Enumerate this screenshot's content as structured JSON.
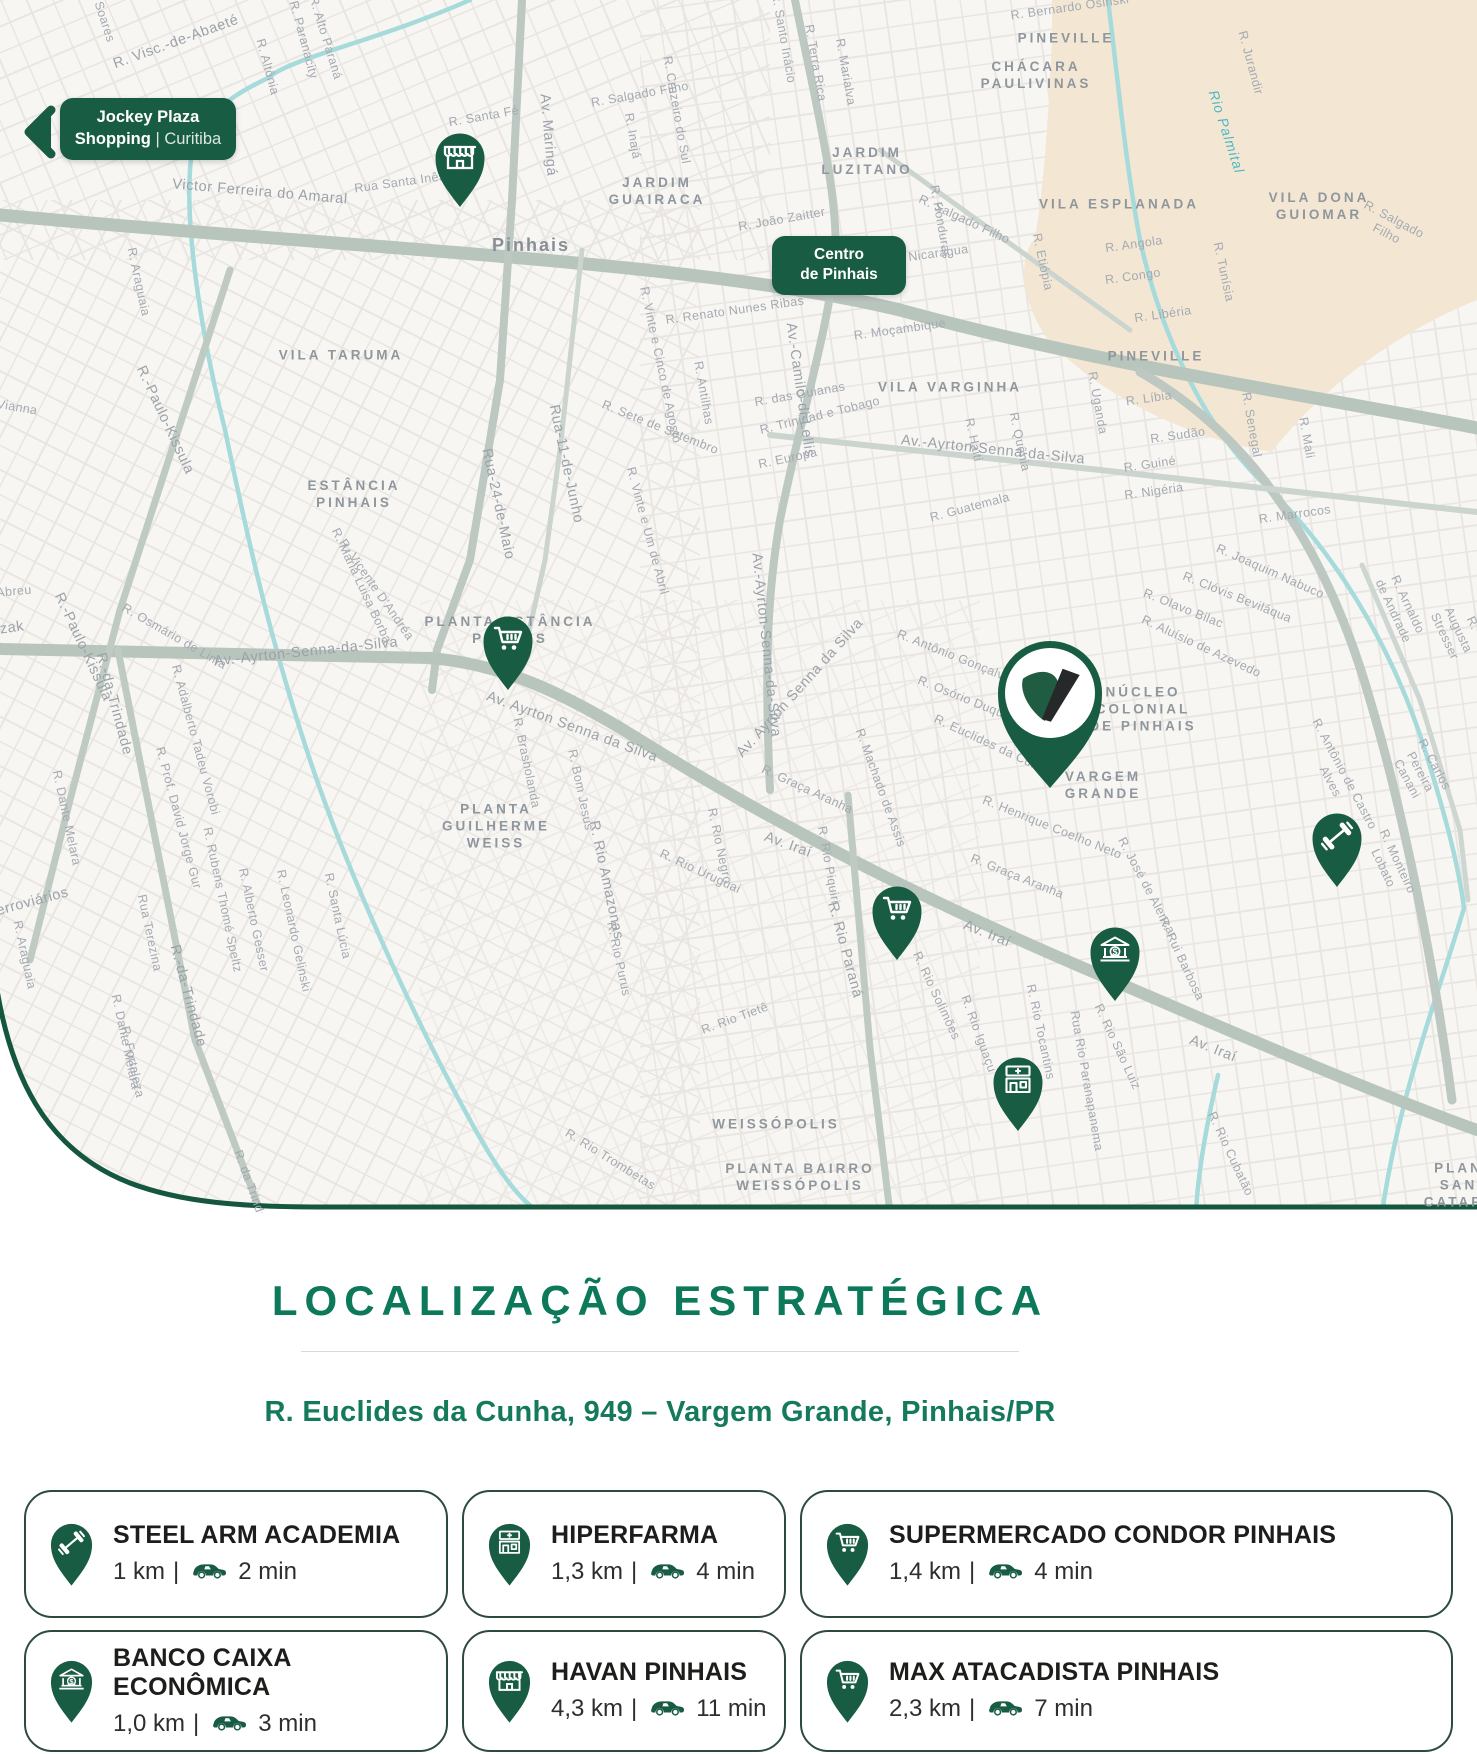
{
  "brand": {
    "green": "#195C44",
    "title_green": "#0C795A",
    "address_green": "#157A5C",
    "map_bg": "#F8F6F3",
    "tan": "#F3E7D4",
    "river": "#A6DADB",
    "road": "#B8C5BD",
    "logo_leaf": "#1F5C41",
    "logo_slash": "#26292A"
  },
  "map": {
    "badges": {
      "jockey": {
        "line1": "Jockey Plaza",
        "line2_bold": "Shopping",
        "line2_sep": "|",
        "line2_rest": "Curitiba"
      },
      "centro": {
        "line1": "Centro",
        "line2": "de Pinhais"
      }
    },
    "pins": [
      {
        "name": "store-pin",
        "icon": "store",
        "x": 460,
        "y": 208,
        "w": 56
      },
      {
        "name": "supermarket-pin-1",
        "icon": "cart",
        "x": 508,
        "y": 691,
        "w": 56
      },
      {
        "name": "property-pin",
        "icon": "vlogo",
        "x": 1050,
        "y": 792,
        "w": 122
      },
      {
        "name": "gym-pin",
        "icon": "dumbbell",
        "x": 1337,
        "y": 888,
        "w": 56
      },
      {
        "name": "supermarket-pin-2",
        "icon": "cart",
        "x": 897,
        "y": 961,
        "w": 56
      },
      {
        "name": "bank-pin",
        "icon": "bank",
        "x": 1115,
        "y": 1002,
        "w": 56
      },
      {
        "name": "pharmacy-pin",
        "icon": "pharmacy",
        "x": 1018,
        "y": 1132,
        "w": 56
      }
    ],
    "labels": [
      {
        "t": "VILA TARUMA",
        "x": 341,
        "y": 356,
        "r": 0,
        "k": "hood"
      },
      {
        "t": "ESTÂNCIA\nPINHAIS",
        "x": 354,
        "y": 495,
        "r": 0,
        "k": "hood"
      },
      {
        "t": "PLANTA ESTÂNCIA\nPINHAIS",
        "x": 510,
        "y": 631,
        "r": 0,
        "k": "hood"
      },
      {
        "t": "PLANTA\nGUILHERME\nWEISS",
        "x": 496,
        "y": 827,
        "r": 0,
        "k": "hood"
      },
      {
        "t": "JARDIM\nGUAIRACA",
        "x": 657,
        "y": 192,
        "r": 0,
        "k": "hood"
      },
      {
        "t": "JARDIM\nLUZITANO",
        "x": 867,
        "y": 162,
        "r": 0,
        "k": "hood"
      },
      {
        "t": "CHÁCARA\nPAULIVINAS",
        "x": 1036,
        "y": 76,
        "r": 0,
        "k": "hood"
      },
      {
        "t": "PINEVILLE",
        "x": 1066,
        "y": 39,
        "r": 0,
        "k": "hood"
      },
      {
        "t": "PINEVILLE",
        "x": 1156,
        "y": 357,
        "r": 0,
        "k": "hood"
      },
      {
        "t": "VILA ESPLANADA",
        "x": 1119,
        "y": 205,
        "r": 0,
        "k": "hood"
      },
      {
        "t": "VILA DONA\nGUIOMAR",
        "x": 1319,
        "y": 207,
        "r": 0,
        "k": "hood"
      },
      {
        "t": "VILA VARGINHA",
        "x": 950,
        "y": 388,
        "r": 0,
        "k": "hood"
      },
      {
        "t": "NÚCLEO\nCOLONIAL\nDE PINHAIS",
        "x": 1143,
        "y": 710,
        "r": 0,
        "k": "hood"
      },
      {
        "t": "VARGEM\nGRANDE",
        "x": 1103,
        "y": 786,
        "r": 0,
        "k": "hood"
      },
      {
        "t": "WEISSÓPOLIS",
        "x": 776,
        "y": 1125,
        "r": 0,
        "k": "hood"
      },
      {
        "t": "PLANTA BAIRRO\nWEISSÓPOLIS",
        "x": 800,
        "y": 1178,
        "r": 0,
        "k": "hood"
      },
      {
        "t": "PLANTA SANTA\nCATARINA",
        "x": 1470,
        "y": 1186,
        "r": 0,
        "k": "hood"
      },
      {
        "t": "Pinhais",
        "x": 531,
        "y": 245,
        "r": 0,
        "k": "city"
      },
      {
        "t": "Rio Palmital",
        "x": 1226,
        "y": 132,
        "r": 72,
        "k": "river"
      },
      {
        "t": "Victor Ferreira do Amaral",
        "x": 260,
        "y": 192,
        "r": 5,
        "k": "st2"
      },
      {
        "t": "R. Visc.-de-Abaeté",
        "x": 176,
        "y": 42,
        "r": -20,
        "k": "st2"
      },
      {
        "t": "Soares",
        "x": 104,
        "y": 22,
        "r": 72,
        "k": "st"
      },
      {
        "t": "R. Altônia",
        "x": 267,
        "y": 67,
        "r": 75,
        "k": "st"
      },
      {
        "t": "R. Paranacity",
        "x": 303,
        "y": 40,
        "r": 75,
        "k": "st"
      },
      {
        "t": "R. Alto Paraná",
        "x": 325,
        "y": 38,
        "r": 73,
        "k": "st"
      },
      {
        "t": "R. Santa Fé",
        "x": 484,
        "y": 117,
        "r": -10,
        "k": "st"
      },
      {
        "t": "Rua Santa Inês",
        "x": 400,
        "y": 183,
        "r": -8,
        "k": "st"
      },
      {
        "t": "Av. Maringá",
        "x": 548,
        "y": 135,
        "r": 85,
        "k": "st2"
      },
      {
        "t": "R. Salgado Filho",
        "x": 640,
        "y": 95,
        "r": -10,
        "k": "st"
      },
      {
        "t": "R. Inajá",
        "x": 632,
        "y": 136,
        "r": 80,
        "k": "st"
      },
      {
        "t": "R. Cruzeiro do Sul",
        "x": 676,
        "y": 110,
        "r": 80,
        "k": "st"
      },
      {
        "t": "R. Santo Inácio",
        "x": 783,
        "y": 38,
        "r": 80,
        "k": "st"
      },
      {
        "t": "R. Terra Rica",
        "x": 815,
        "y": 63,
        "r": 80,
        "k": "st"
      },
      {
        "t": "R. Marialva",
        "x": 845,
        "y": 72,
        "r": 80,
        "k": "st"
      },
      {
        "t": "R. Bernardo Osinski",
        "x": 1070,
        "y": 8,
        "r": -8,
        "k": "st"
      },
      {
        "t": "R. Jurandir",
        "x": 1250,
        "y": 63,
        "r": 75,
        "k": "st"
      },
      {
        "t": "R. Salgado Filho",
        "x": 964,
        "y": 220,
        "r": 25,
        "k": "st"
      },
      {
        "t": "R. Salgado Filho",
        "x": 1390,
        "y": 227,
        "r": 28,
        "k": "st"
      },
      {
        "t": "R. João Zaitter",
        "x": 782,
        "y": 220,
        "r": -10,
        "k": "st"
      },
      {
        "t": "R. Nicarágua",
        "x": 930,
        "y": 255,
        "r": -8,
        "k": "st"
      },
      {
        "t": "R. Honduras",
        "x": 940,
        "y": 222,
        "r": 80,
        "k": "st"
      },
      {
        "t": "R. Etiópia",
        "x": 1042,
        "y": 262,
        "r": 78,
        "k": "st"
      },
      {
        "t": "R. Angola",
        "x": 1134,
        "y": 245,
        "r": -8,
        "k": "st"
      },
      {
        "t": "R. Congo",
        "x": 1133,
        "y": 277,
        "r": -8,
        "k": "st"
      },
      {
        "t": "R. Libéria",
        "x": 1163,
        "y": 315,
        "r": -8,
        "k": "st"
      },
      {
        "t": "R. Tunísia",
        "x": 1223,
        "y": 272,
        "r": 78,
        "k": "st"
      },
      {
        "t": "R. Uganda",
        "x": 1097,
        "y": 403,
        "r": 80,
        "k": "st"
      },
      {
        "t": "R. Líbia",
        "x": 1149,
        "y": 399,
        "r": -8,
        "k": "st"
      },
      {
        "t": "R. Sudão",
        "x": 1178,
        "y": 436,
        "r": -8,
        "k": "st"
      },
      {
        "t": "R. Guiné",
        "x": 1150,
        "y": 465,
        "r": -8,
        "k": "st"
      },
      {
        "t": "R. Nigéria",
        "x": 1154,
        "y": 492,
        "r": -8,
        "k": "st"
      },
      {
        "t": "R. Senegal",
        "x": 1251,
        "y": 425,
        "r": 80,
        "k": "st"
      },
      {
        "t": "R. Mali",
        "x": 1306,
        "y": 438,
        "r": 80,
        "k": "st"
      },
      {
        "t": "R. Marrocos",
        "x": 1295,
        "y": 515,
        "r": -8,
        "k": "st"
      },
      {
        "t": "R. Moçambique",
        "x": 900,
        "y": 330,
        "r": -8,
        "k": "st"
      },
      {
        "t": "R. Renato Nunes Ribas",
        "x": 735,
        "y": 311,
        "r": -8,
        "k": "st"
      },
      {
        "t": "R. das Guianas",
        "x": 800,
        "y": 395,
        "r": -10,
        "k": "st"
      },
      {
        "t": "R. Haiti",
        "x": 973,
        "y": 440,
        "r": 78,
        "k": "st"
      },
      {
        "t": "R. Quênia",
        "x": 1019,
        "y": 442,
        "r": 78,
        "k": "st"
      },
      {
        "t": "R. Guatemala",
        "x": 970,
        "y": 508,
        "r": -15,
        "k": "st"
      },
      {
        "t": "Av.-Camilo-di-Lellis",
        "x": 800,
        "y": 390,
        "r": 82,
        "k": "st2"
      },
      {
        "t": "R.-Paulo-Kissula",
        "x": 165,
        "y": 420,
        "r": 65,
        "k": "st2"
      },
      {
        "t": "R.-Paulo-Kissula",
        "x": 83,
        "y": 647,
        "r": 65,
        "k": "st2"
      },
      {
        "t": "R. Araguaia",
        "x": 138,
        "y": 282,
        "r": 78,
        "k": "st"
      },
      {
        "t": "Vianna",
        "x": 17,
        "y": 408,
        "r": 10,
        "k": "st"
      },
      {
        "t": "R. Osmário de Lima",
        "x": 174,
        "y": 637,
        "r": 30,
        "k": "st"
      },
      {
        "t": "Rua-24-de-Maio",
        "x": 498,
        "y": 504,
        "r": 78,
        "k": "st2"
      },
      {
        "t": "Rua-11-de-Junho",
        "x": 566,
        "y": 464,
        "r": 78,
        "k": "st2"
      },
      {
        "t": "R. Sete de Setembro",
        "x": 660,
        "y": 428,
        "r": 22,
        "k": "st"
      },
      {
        "t": "R. Vinte e Um de Abril",
        "x": 647,
        "y": 531,
        "r": 75,
        "k": "st"
      },
      {
        "t": "R. Vicente D'Andréa",
        "x": 376,
        "y": 590,
        "r": 55,
        "k": "st"
      },
      {
        "t": "R. Maria Luisa Borba",
        "x": 361,
        "y": 586,
        "r": 65,
        "k": "st"
      },
      {
        "t": "R. Europa",
        "x": 788,
        "y": 459,
        "r": -12,
        "k": "st"
      },
      {
        "t": "R. Trinidad e Tobago",
        "x": 820,
        "y": 416,
        "r": -14,
        "k": "st"
      },
      {
        "t": "R. Antilhas",
        "x": 703,
        "y": 393,
        "r": 80,
        "k": "st"
      },
      {
        "t": "R. Vinte e Cinco de Agosto",
        "x": 660,
        "y": 365,
        "r": 78,
        "k": "st"
      },
      {
        "t": "Av.-Ayrton-Senna-da-Silva",
        "x": 306,
        "y": 652,
        "r": -6,
        "k": "st2"
      },
      {
        "t": "Av. Ayrton Senna da Silva",
        "x": 572,
        "y": 727,
        "r": 20,
        "k": "st2"
      },
      {
        "t": "Av.-Ayrton-Senna-da-Silva",
        "x": 993,
        "y": 450,
        "r": 6,
        "k": "st2"
      },
      {
        "t": "Av.-Ayrton-Senna-da-Silva",
        "x": 766,
        "y": 645,
        "r": 84,
        "k": "st2"
      },
      {
        "t": "Av. Ayrton Senna da Silva",
        "x": 800,
        "y": 688,
        "r": -48,
        "k": "st2"
      },
      {
        "t": "Abreu",
        "x": 14,
        "y": 592,
        "r": -5,
        "k": "st"
      },
      {
        "t": "zak",
        "x": 12,
        "y": 628,
        "r": -8,
        "k": "st2"
      },
      {
        "t": "R.-da-Trindade",
        "x": 114,
        "y": 704,
        "r": 75,
        "k": "st2"
      },
      {
        "t": "R.-da-Trindade",
        "x": 188,
        "y": 996,
        "r": 75,
        "k": "st2"
      },
      {
        "t": "R. Dante Melara",
        "x": 66,
        "y": 818,
        "r": 78,
        "k": "st"
      },
      {
        "t": "R. Dante Melara",
        "x": 125,
        "y": 1042,
        "r": 78,
        "k": "st"
      },
      {
        "t": "Ferroviários",
        "x": 28,
        "y": 903,
        "r": -15,
        "k": "st2"
      },
      {
        "t": "R. Santa Lúcia",
        "x": 337,
        "y": 916,
        "r": 78,
        "k": "st"
      },
      {
        "t": "Rua Terezina",
        "x": 149,
        "y": 933,
        "r": 78,
        "k": "st"
      },
      {
        "t": "R. Fortaleza",
        "x": 132,
        "y": 1062,
        "r": 78,
        "k": "st"
      },
      {
        "t": "R. Alberto Gesser",
        "x": 253,
        "y": 920,
        "r": 78,
        "k": "st"
      },
      {
        "t": "R. Leonardo Gelinski",
        "x": 293,
        "y": 931,
        "r": 78,
        "k": "st"
      },
      {
        "t": "R. Rubens Thomé Speltz",
        "x": 222,
        "y": 900,
        "r": 78,
        "k": "st"
      },
      {
        "t": "R. da Trindade",
        "x": 252,
        "y": 1192,
        "r": 70,
        "k": "st"
      },
      {
        "t": "R. Araguaia",
        "x": 24,
        "y": 955,
        "r": 78,
        "k": "st"
      },
      {
        "t": "R. Adalberto Tadeu Vorobi",
        "x": 195,
        "y": 740,
        "r": 75,
        "k": "st"
      },
      {
        "t": "R. Prof. David Jorge Gur",
        "x": 178,
        "y": 818,
        "r": 75,
        "k": "st"
      },
      {
        "t": "R. Bom Jesus",
        "x": 580,
        "y": 790,
        "r": 78,
        "k": "st"
      },
      {
        "t": "R. Brasholanda",
        "x": 526,
        "y": 763,
        "r": 78,
        "k": "st"
      },
      {
        "t": "R. Rio Amazonas",
        "x": 606,
        "y": 880,
        "r": 78,
        "k": "st2"
      },
      {
        "t": "R. Rio Negro",
        "x": 719,
        "y": 846,
        "r": 78,
        "k": "st"
      },
      {
        "t": "R. Rio Uruguai",
        "x": 700,
        "y": 872,
        "r": 25,
        "k": "st"
      },
      {
        "t": "R. Rio Piquiri",
        "x": 828,
        "y": 865,
        "r": 80,
        "k": "st"
      },
      {
        "t": "R. Rio Paraná",
        "x": 845,
        "y": 950,
        "r": 75,
        "k": "st2"
      },
      {
        "t": "R. Rio Tietê",
        "x": 735,
        "y": 1019,
        "r": -20,
        "k": "st"
      },
      {
        "t": "R. Rio Purus",
        "x": 618,
        "y": 959,
        "r": 78,
        "k": "st"
      },
      {
        "t": "R. Rio Trombetas",
        "x": 610,
        "y": 1160,
        "r": 32,
        "k": "st"
      },
      {
        "t": "R. Rio Solimões",
        "x": 936,
        "y": 996,
        "r": 65,
        "k": "st"
      },
      {
        "t": "R. Rio Iguaçu",
        "x": 978,
        "y": 1034,
        "r": 70,
        "k": "st"
      },
      {
        "t": "R. Rio Tocantins",
        "x": 1040,
        "y": 1032,
        "r": 78,
        "k": "st"
      },
      {
        "t": "Rua Rio Paranapanema",
        "x": 1086,
        "y": 1081,
        "r": 80,
        "k": "st"
      },
      {
        "t": "R. Rio São Luiz",
        "x": 1117,
        "y": 1047,
        "r": 65,
        "k": "st"
      },
      {
        "t": "R. Rui Barbosa",
        "x": 1181,
        "y": 959,
        "r": 65,
        "k": "st"
      },
      {
        "t": "R. Rio Cubatão",
        "x": 1230,
        "y": 1154,
        "r": 65,
        "k": "st"
      },
      {
        "t": "R. José de Alencar",
        "x": 1147,
        "y": 888,
        "r": 62,
        "k": "st"
      },
      {
        "t": "R. Henrique Coelho Neto",
        "x": 1052,
        "y": 828,
        "r": 22,
        "k": "st"
      },
      {
        "t": "R. Graça Aranha",
        "x": 807,
        "y": 790,
        "r": 25,
        "k": "st"
      },
      {
        "t": "R. Graça Aranha",
        "x": 1017,
        "y": 877,
        "r": 22,
        "k": "st"
      },
      {
        "t": "R. Machado de Assis",
        "x": 880,
        "y": 788,
        "r": 70,
        "k": "st"
      },
      {
        "t": "R. Antônio Gonçalves",
        "x": 957,
        "y": 658,
        "r": 22,
        "k": "st"
      },
      {
        "t": "R. Osório Duque",
        "x": 964,
        "y": 699,
        "r": 22,
        "k": "st"
      },
      {
        "t": "R. Euclides da Cunha",
        "x": 993,
        "y": 746,
        "r": 25,
        "k": "st"
      },
      {
        "t": "R. Joaquim Nabuco",
        "x": 1270,
        "y": 572,
        "r": 24,
        "k": "st"
      },
      {
        "t": "R. Clóvis Beviláqua",
        "x": 1237,
        "y": 598,
        "r": 22,
        "k": "st"
      },
      {
        "t": "R. Olavo Bilac",
        "x": 1183,
        "y": 609,
        "r": 22,
        "k": "st"
      },
      {
        "t": "R. Aluísio de Azevedo",
        "x": 1201,
        "y": 647,
        "r": 25,
        "k": "st"
      },
      {
        "t": "R. Arnaldo de Andrade",
        "x": 1400,
        "y": 608,
        "r": 65,
        "k": "st"
      },
      {
        "t": "R. Augusta Stresser",
        "x": 1458,
        "y": 630,
        "r": 65,
        "k": "st"
      },
      {
        "t": "R. Antônio de Castro Alves",
        "x": 1337,
        "y": 778,
        "r": 62,
        "k": "st"
      },
      {
        "t": "R. Carlos Pereira Canani",
        "x": 1420,
        "y": 772,
        "r": 62,
        "k": "st"
      },
      {
        "t": "R. Monteiro Lobato",
        "x": 1390,
        "y": 865,
        "r": 65,
        "k": "st"
      },
      {
        "t": "Av. Iraí",
        "x": 788,
        "y": 845,
        "r": 20,
        "k": "st2"
      },
      {
        "t": "Av. Iraí",
        "x": 987,
        "y": 934,
        "r": 22,
        "k": "st2"
      },
      {
        "t": "Av. Iraí",
        "x": 1213,
        "y": 1049,
        "r": 22,
        "k": "st2"
      }
    ]
  },
  "section": {
    "title": "LOCALIZAÇÃO ESTRATÉGICA",
    "address": "R. Euclides da Cunha, 949 – Vargem Grande, Pinhais/PR",
    "separator": "|",
    "cards": [
      {
        "icon": "dumbbell",
        "name": "STEEL ARM ACADEMIA",
        "distance": "1 km",
        "time": "2 min"
      },
      {
        "icon": "pharmacy",
        "name": "HIPERFARMA",
        "distance": "1,3 km",
        "time": "4 min"
      },
      {
        "icon": "cart",
        "name": "SUPERMERCADO CONDOR PINHAIS",
        "distance": "1,4 km",
        "time": "4 min"
      },
      {
        "icon": "bank",
        "name": "BANCO CAIXA ECONÔMICA",
        "distance": "1,0 km",
        "time": "3 min"
      },
      {
        "icon": "store",
        "name": "HAVAN PINHAIS",
        "distance": "4,3 km",
        "time": "11 min"
      },
      {
        "icon": "cart",
        "name": "MAX ATACADISTA PINHAIS",
        "distance": "2,3 km",
        "time": "7 min"
      }
    ]
  }
}
